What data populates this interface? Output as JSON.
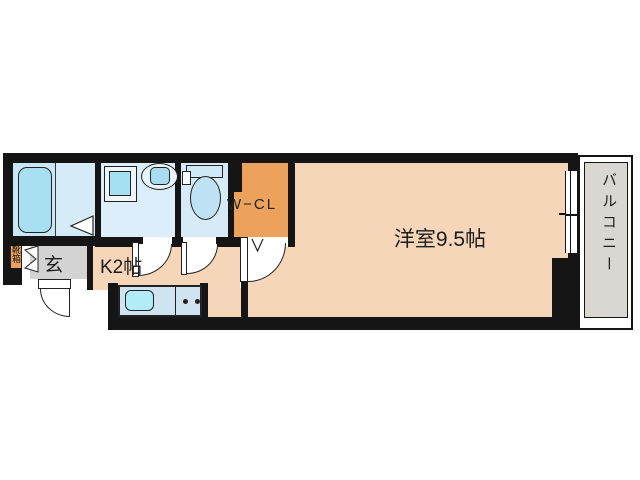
{
  "floorplan": {
    "labels": {
      "western_room": "洋室9.5帖",
      "kitchen": "K2帖",
      "entrance": "玄",
      "shoe_cabinet": "靴箱",
      "walk_in_closet": "W−CL",
      "balcony": "バルコニー"
    },
    "colors": {
      "wall": "#151515",
      "main_room": "#f6d6b8",
      "closet": "#eca25c",
      "entrance_hall": "#d3d3d3",
      "balcony": "#dad6d1",
      "bathroom": "#c8e6f4",
      "washroom": "#dceef9",
      "toilet_room": "#d6ebf7",
      "fixture_cyan": "#a8e0f1",
      "counter": "#cfe3f1"
    }
  }
}
